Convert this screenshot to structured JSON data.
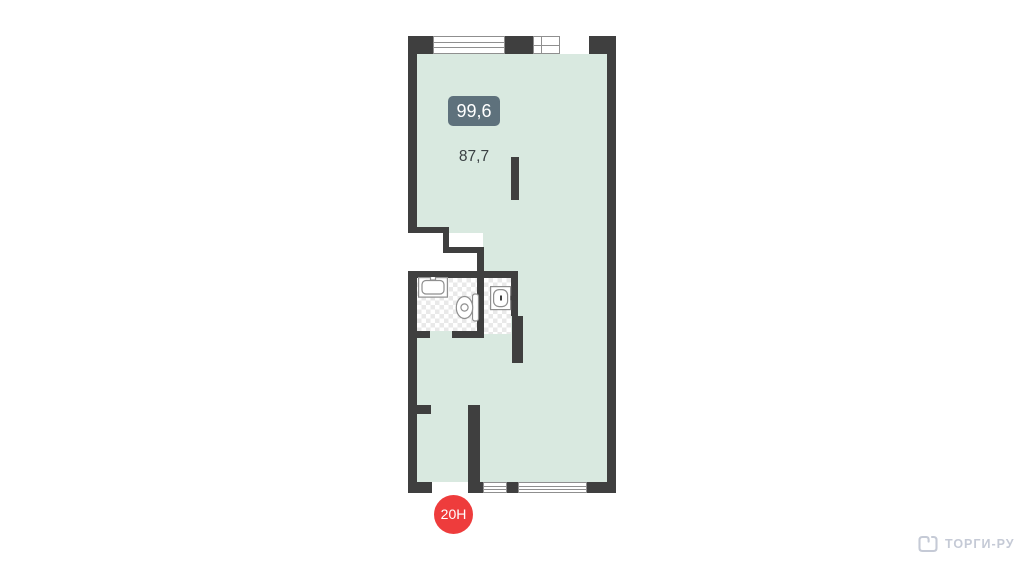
{
  "plan": {
    "area_badge": "99,6",
    "area_label": "87,7",
    "unit_marker": "20Н"
  },
  "footer": {
    "logo_text": "ТОРГИ-РУ"
  },
  "colors": {
    "wall": "#3f3f3f",
    "floor": "#d9e9e0",
    "badge_bg": "#5e717c",
    "badge_text": "#ffffff",
    "marker_bg": "#ee3c3c",
    "marker_text": "#ffffff",
    "label_text": "#3a4043",
    "logo": "#c5cad6",
    "wet_zone_checker": "#e9e9e9",
    "fixture_stroke": "#8f8f8f",
    "window_frame": "#8f8f8f"
  }
}
